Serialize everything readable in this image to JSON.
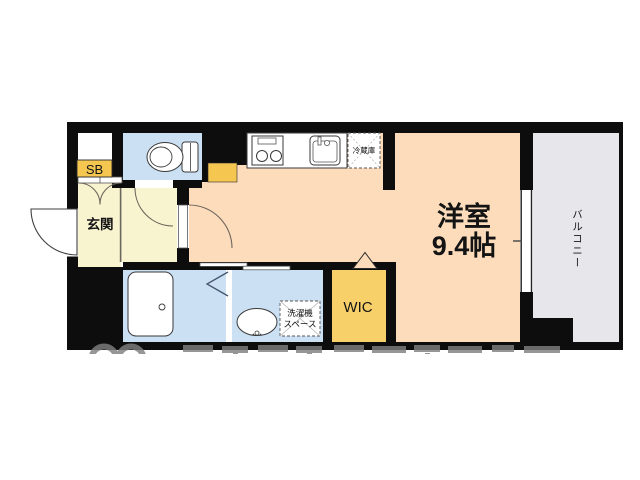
{
  "floorplan": {
    "rooms": {
      "main_room": {
        "name_line1": "洋室",
        "name_line2": "9.4帖"
      },
      "entrance": {
        "name": "玄関"
      },
      "wic": {
        "name": "WIC"
      },
      "balcony": {
        "name": "バルコニー"
      },
      "shoe_box": {
        "name": "SB"
      },
      "refrigerator": {
        "name": "冷蔵庫"
      },
      "washer_space": {
        "name_line1": "洗濯機",
        "name_line2": "スペース"
      }
    },
    "colors": {
      "wall": "#0d0d0d",
      "main_room": "#fcdcbb",
      "entrance_hall": "#f8f4d0",
      "wet_rooms": "#cce0f4",
      "wic": "#f8d06a",
      "accent_yellow": "#f5c751",
      "balcony": "#e6e6eb",
      "watermark": "#7f7f7f"
    }
  }
}
